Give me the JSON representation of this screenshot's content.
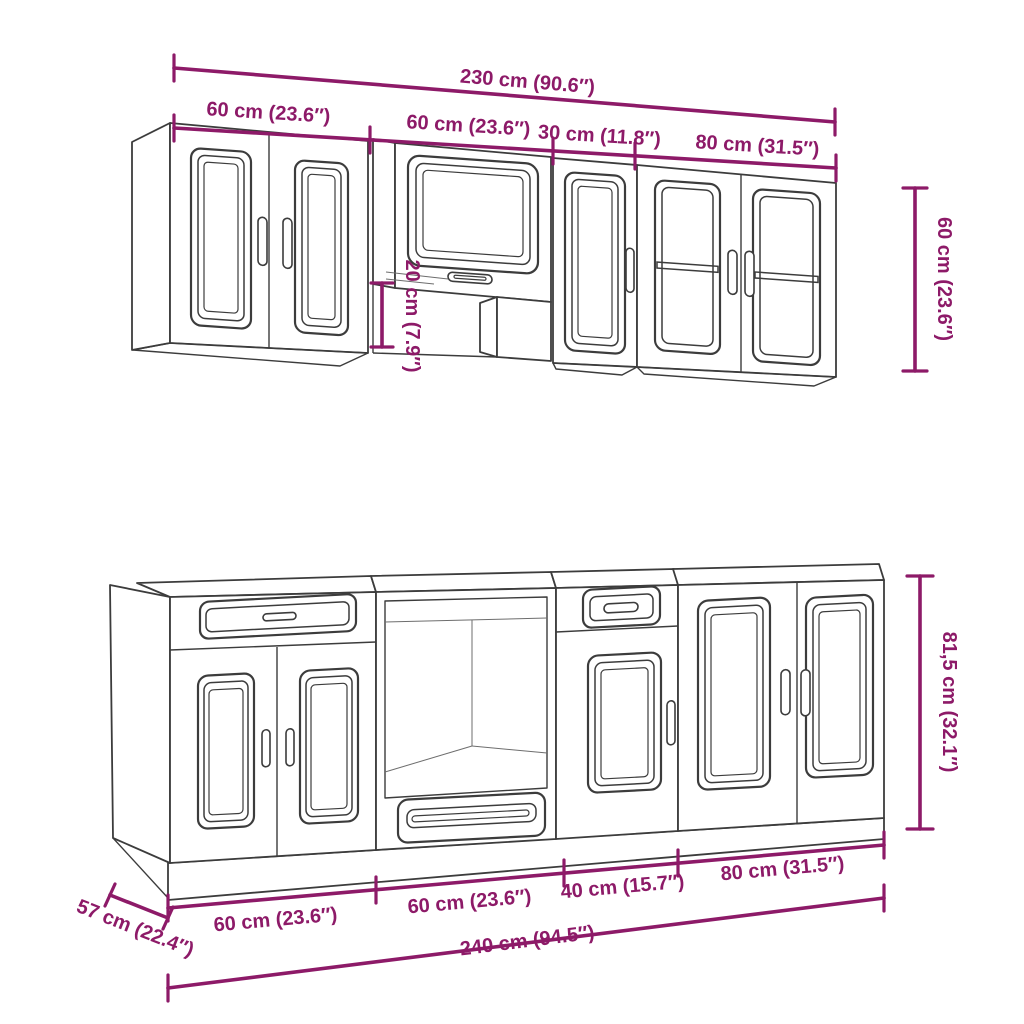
{
  "figure": {
    "type": "kitchen-cabinet-set-dimension-diagram",
    "background_color": "#ffffff",
    "line_color": "#3c3c3c",
    "dimension_color": "#8d1a68"
  },
  "wall_section": {
    "total_width": "230 cm (90.6″)",
    "segments": [
      "60 cm (23.6″)",
      "60 cm (23.6″)",
      "30 cm (11.8″)",
      "80 cm (31.5″)"
    ],
    "height": "60 cm (23.6″)",
    "hood_gap_height": "20 cm (7.9″)"
  },
  "base_section": {
    "total_width": "240 cm (94.5″)",
    "segments": [
      "60 cm (23.6″)",
      "60 cm (23.6″)",
      "40 cm (15.7″)",
      "80 cm (31.5″)"
    ],
    "height": "81,5 cm (32.1″)",
    "depth": "57 cm (22.4″)"
  }
}
